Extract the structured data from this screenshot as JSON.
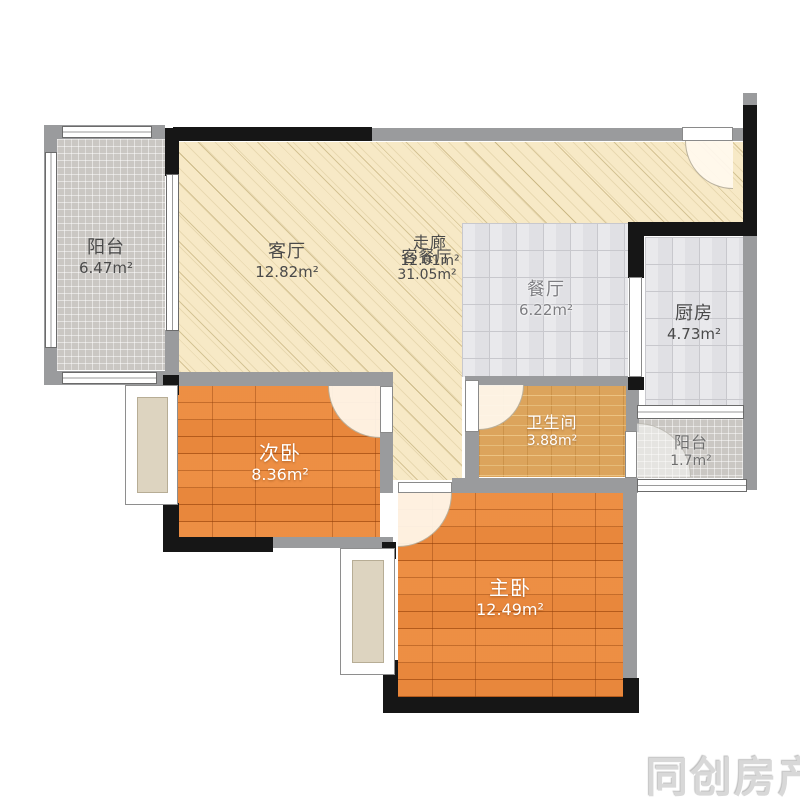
{
  "watermark": {
    "text": "同创房产"
  },
  "rooms": {
    "balcony_left": {
      "name": "阳台",
      "area": "6.47m²"
    },
    "living": {
      "name": "客厅",
      "area": "12.82m²"
    },
    "corridor": {
      "name": "走廊",
      "area": "12.01m²"
    },
    "living_dining": {
      "name": "客餐厅",
      "area": "31.05m²"
    },
    "dining": {
      "name": "餐厅",
      "area": "6.22m²"
    },
    "kitchen": {
      "name": "厨房",
      "area": "4.73m²"
    },
    "bedroom_second": {
      "name": "次卧",
      "area": "8.36m²"
    },
    "bathroom": {
      "name": "卫生间",
      "area": "3.88m²"
    },
    "balcony_right": {
      "name": "阳台",
      "area": "1.7m²"
    },
    "bedroom_master": {
      "name": "主卧",
      "area": "12.49m²"
    }
  },
  "colors": {
    "wood_floor": "#e07b2c",
    "cream_floor": "#f7e9c6",
    "tile_gray": "#e0e0e4",
    "tile_fine_gray": "#cac7c3",
    "tile_bath": "#dca45c",
    "wall_black": "#161616",
    "wall_gray": "#9a9b9d",
    "bay_inner": "#ddd4c0"
  }
}
